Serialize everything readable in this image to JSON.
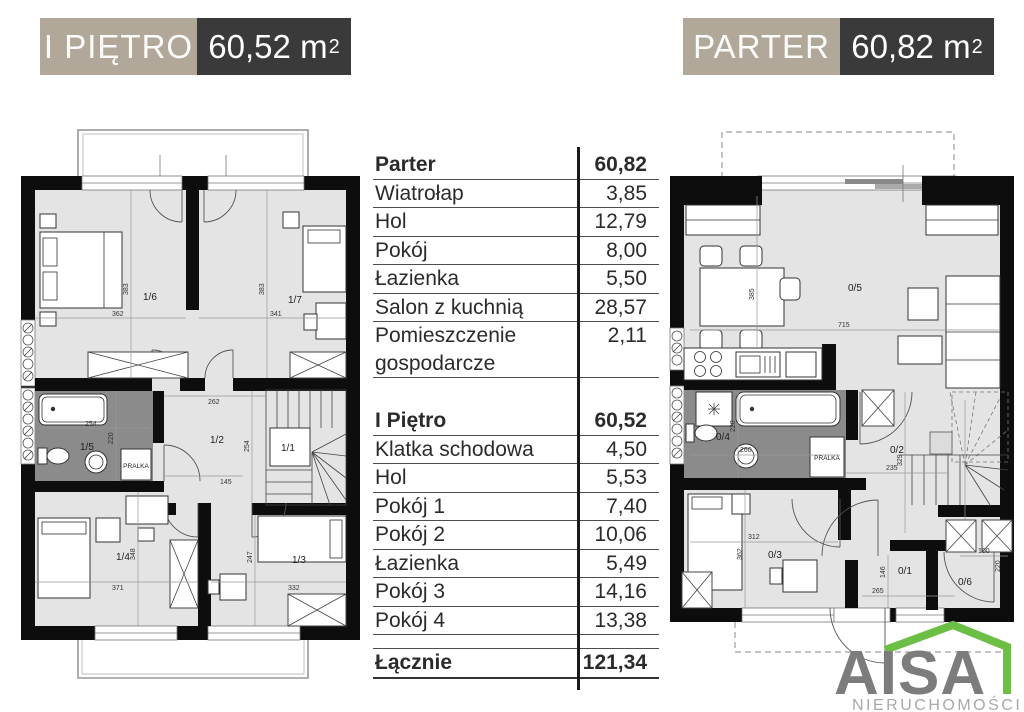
{
  "header_left": {
    "title": "I PIĘTRO",
    "area_value": "60,52",
    "area_unit": "m",
    "area_sup": "2"
  },
  "header_right": {
    "title": "PARTER",
    "area_value": "60,82",
    "area_unit": "m",
    "area_sup": "2"
  },
  "table": {
    "sections": [
      {
        "header": {
          "label": "Parter",
          "value": "60,82"
        },
        "rows": [
          {
            "label": "Wiatrołap",
            "value": "3,85"
          },
          {
            "label": "Hol",
            "value": "12,79"
          },
          {
            "label": "Pokój",
            "value": "8,00"
          },
          {
            "label": "Łazienka",
            "value": "5,50"
          },
          {
            "label": "Salon z kuchnią",
            "value": "28,57"
          },
          {
            "label": "Pomieszczenie gospodarcze",
            "value": "2,11"
          }
        ]
      },
      {
        "header": {
          "label": "I Piętro",
          "value": "60,52"
        },
        "rows": [
          {
            "label": "Klatka schodowa",
            "value": "4,50"
          },
          {
            "label": "Hol",
            "value": "5,53"
          },
          {
            "label": "Pokój 1",
            "value": "7,40"
          },
          {
            "label": "Pokój 2",
            "value": "10,06"
          },
          {
            "label": "Łazienka",
            "value": "5,49"
          },
          {
            "label": "Pokój 3",
            "value": "14,16"
          },
          {
            "label": "Pokój 4",
            "value": "13,38"
          }
        ]
      }
    ],
    "total": {
      "label": "Łącznie",
      "value": "121,34"
    }
  },
  "plan_first_floor": {
    "pralka": "PRALKA",
    "rooms": {
      "r11": "1/1",
      "r12": "1/2",
      "r13": "1/3",
      "r14": "1/4",
      "r15": "1/5",
      "r16": "1/6",
      "r17": "1/7"
    },
    "dims": {
      "w16": "362",
      "h16": "383",
      "w17": "341",
      "h17": "383",
      "tub": "254",
      "bath_h": "220",
      "hall_w": "262",
      "hall_w2": "145",
      "hall_h": "254",
      "w14": "371",
      "h14": "348",
      "w13": "332",
      "h13": "247"
    }
  },
  "plan_ground_floor": {
    "pralka": "PRALKA",
    "rooms": {
      "r01": "0/1",
      "r02": "0/2",
      "r03": "0/3",
      "r04": "0/4",
      "r05": "0/5",
      "r06": "0/6"
    },
    "dims": {
      "salon_w": "715",
      "salon_h": "385",
      "bath_w": "260",
      "bath_h": "220",
      "hall_w": "235",
      "hall_h": "329",
      "w03": "312",
      "h03": "362",
      "w01": "265",
      "h01": "146",
      "w06": "100",
      "h06": "220"
    }
  },
  "logo": {
    "name": "AISA",
    "subtitle": "NIERUCHOMOŚCI"
  },
  "colors": {
    "accent_taupe": "#b2a89a",
    "accent_dark": "#3a3a3a",
    "floor_fill": "#e4e4e4",
    "bath_fill": "#8b8b8b",
    "logo_green": "#6cbf45",
    "logo_gray": "#7c7c7c"
  }
}
